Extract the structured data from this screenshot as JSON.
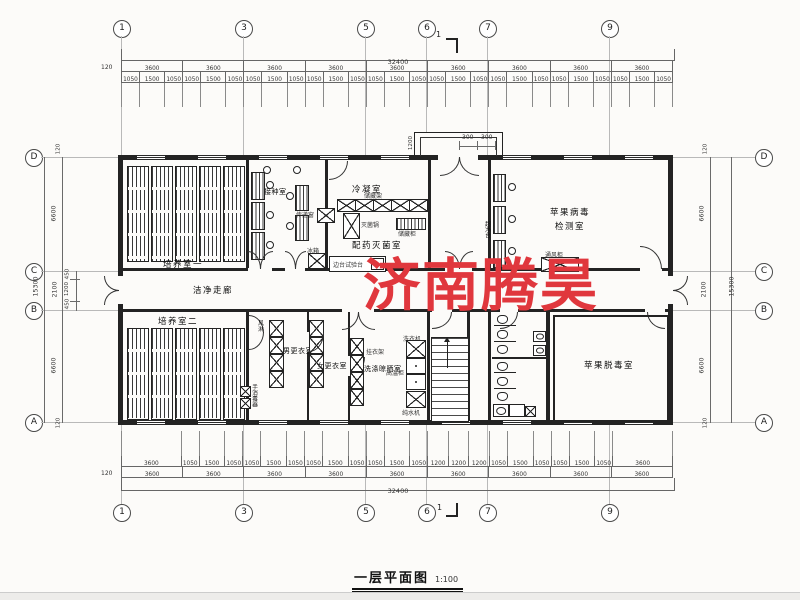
{
  "title": {
    "text": "一层平面图",
    "scale": "1:100"
  },
  "watermark": {
    "text": "济南腾昊",
    "color": "#e0373d"
  },
  "grid_bubbles": {
    "top": [
      "1",
      "3",
      "5",
      "6",
      "7",
      "9"
    ],
    "bottom": [
      "1",
      "3",
      "5",
      "6",
      "7",
      "9"
    ],
    "left": [
      "D",
      "C",
      "B",
      "A"
    ],
    "right": [
      "D",
      "C",
      "B",
      "A"
    ]
  },
  "section_marks": {
    "top": "1",
    "bottom": "1"
  },
  "dimensions": {
    "top": {
      "overall": "32400",
      "edge": "120",
      "bays": [
        "3600",
        "3600",
        "3600",
        "3600",
        "3600",
        "3600",
        "3600",
        "3600",
        "3600"
      ],
      "detail": [
        "1050",
        "1500",
        "1050",
        "1050",
        "1500",
        "1050",
        "1050",
        "1500",
        "1050",
        "1050",
        "1500",
        "1050",
        "1050",
        "1500",
        "1050",
        "1050",
        "1500",
        "1050",
        "1050",
        "1500",
        "1050",
        "1050",
        "1500",
        "1050",
        "1050",
        "1500",
        "1050"
      ]
    },
    "bottom": {
      "overall": "32400",
      "edge": "120",
      "bays": [
        "3600",
        "3600",
        "3600",
        "3600",
        "3600",
        "3600",
        "3600",
        "3600",
        "3600"
      ],
      "detail": [
        "3600",
        "1050",
        "1500",
        "1050",
        "1050",
        "1500",
        "1050",
        "1050",
        "1500",
        "1050",
        "1050",
        "1500",
        "1050",
        "1200",
        "1200",
        "1200",
        "1050",
        "1500",
        "1050",
        "1050",
        "1500",
        "1050",
        "3600"
      ]
    },
    "left": {
      "overall": "15300",
      "segments": [
        "6600",
        "2100",
        "6600"
      ],
      "sub": [
        "450",
        "1200",
        "450"
      ],
      "edge_top": "120",
      "edge_bottom": "120"
    },
    "right": {
      "overall": "15300",
      "segments": [
        "6600",
        "2100",
        "6600"
      ],
      "edge_top": "120",
      "edge_bottom": "120"
    },
    "porch": {
      "depth": "1200",
      "side_a": "300",
      "side_b": "300"
    }
  },
  "rooms": {
    "cultivation1": "培养室一",
    "inoculation": "接种室",
    "condensation": "冷凝室",
    "dispensing": "配药灭菌室",
    "virus_test_line1": "苹果病毒",
    "virus_test_line2": "检测室",
    "corridor": "洁净走廊",
    "cultivation2": "培养室二",
    "men_changing": "男更衣室",
    "women_changing": "女更衣室",
    "washing": "洗涤晾晒室",
    "detox": "苹果脱毒室"
  },
  "equipment": {
    "pass_window": "传递窗",
    "fridge": "冰箱",
    "sterilizer": "灭菌锅",
    "storage_rack": "储藏架",
    "storage_cabinet": "储藏柜",
    "side_bench": "边台试验台",
    "clean_bench": "超净台",
    "fume_hood": "通风柜",
    "air_shower": "风淋",
    "hand_sanitizer": "手消毒器",
    "coat_rack": "挂衣架",
    "washer": "洗衣机",
    "hot_cabinet": "高温柜",
    "water_purifier": "纯水机"
  }
}
